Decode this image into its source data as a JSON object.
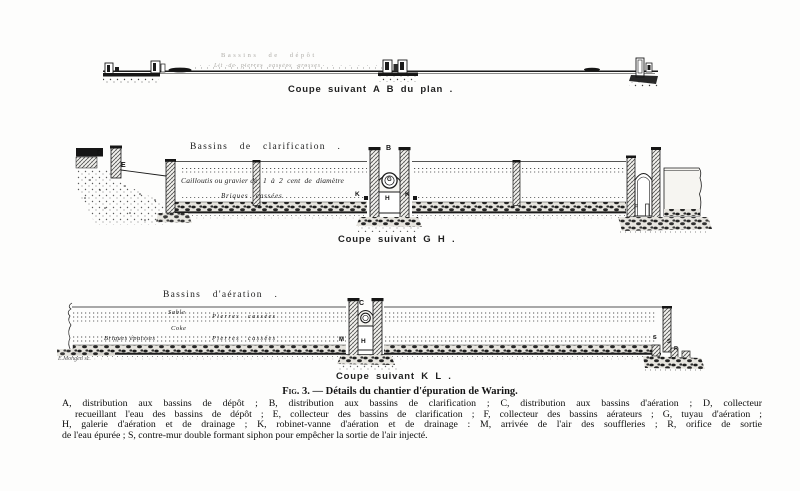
{
  "page": {
    "background": "#fdfdfc",
    "ink": "#1b1b1b"
  },
  "coupe_ab": {
    "ghost_title": "Bassins de dépôt",
    "ghost_subtitle": "Lit de pierres cassées grosses",
    "caption": "Coupe suivant A B  du plan ."
  },
  "coupe_gh": {
    "title": "Bassins de clarification .",
    "gravel_left": "Cailloutis ou gravier de",
    "gravel_right": "1 à 2 cent de diamètre",
    "floor_label": "Briques cassées",
    "caption": "Coupe suivant G H .",
    "labels": {
      "d": "D",
      "e": "E",
      "b": "B",
      "g": "G",
      "h": "H",
      "k_left": "K",
      "k_right": "K",
      "f": "F"
    }
  },
  "coupe_kl": {
    "title": "Bassins d'aération .",
    "layers": {
      "sable": "Sable",
      "pierres_top": "Pierres cassées",
      "coke": "Coke",
      "briques": "Briques épaisses",
      "pierres_bottom": "Pierres cassées"
    },
    "caption": "Coupe suivant K L .",
    "labels": {
      "c": "C",
      "m": "M",
      "h": "H",
      "s_left": "S",
      "s_right": "S",
      "r": "R"
    },
    "engraver": "E.Mongen sc."
  },
  "figure": {
    "fig_label": "Fig. 3.",
    "fig_title": " — Détails du chantier d'épuration de Waring.",
    "legend_lines": [
      "A, distribution aux bassins de dépôt ; B, distribution aux bassins de clarification ; C, distribution aux bassins d'aération ; D, collecteur",
      "recueillant l'eau des bassins de dépôt ; E, collecteur des bassins de clarification ; F, collecteur des bassins aérateurs ; G, tuyau d'aération ;",
      "H, galerie d'aération et de drainage ; K, robinet-vanne d'aération et de drainage : M, arrivée de l'air des souffleries ; R, orifice de sortie",
      "de l'eau épurée ; S, contre-mur double formant siphon pour empêcher la sortie de l'air injecté."
    ]
  }
}
